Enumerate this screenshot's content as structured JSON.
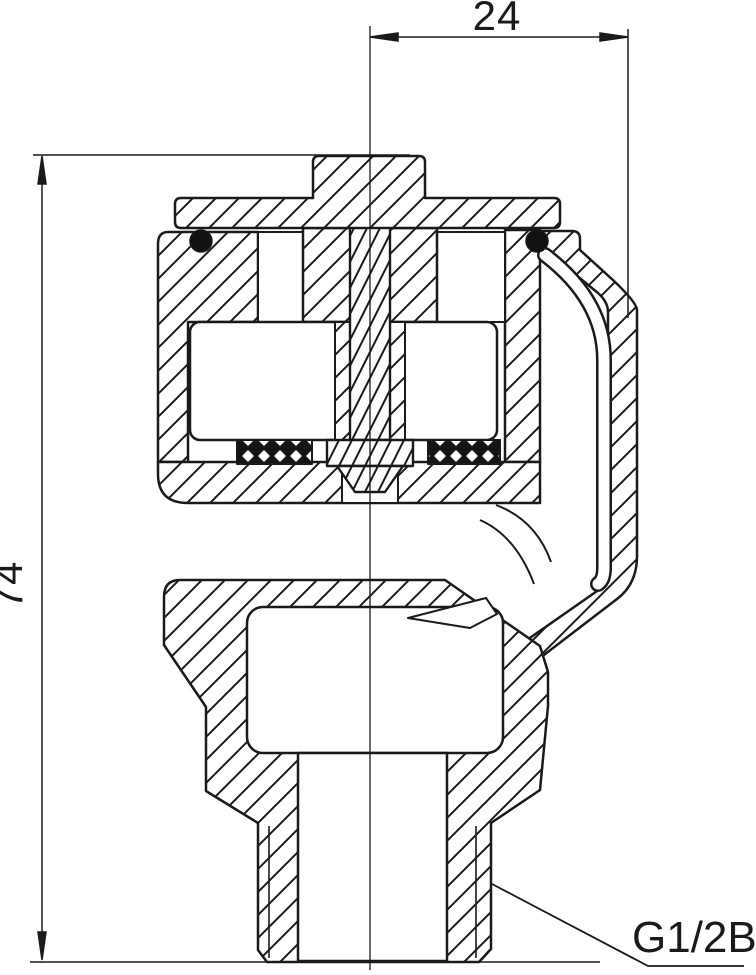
{
  "drawing": {
    "type": "engineering-section-drawing",
    "subject": "threaded valve cross-section",
    "paper_color": "#ffffff",
    "line_color": "#1a1a1a",
    "annotations": {
      "width_dim": "24",
      "height_dim": "74",
      "thread_label": "G1/2B"
    }
  }
}
